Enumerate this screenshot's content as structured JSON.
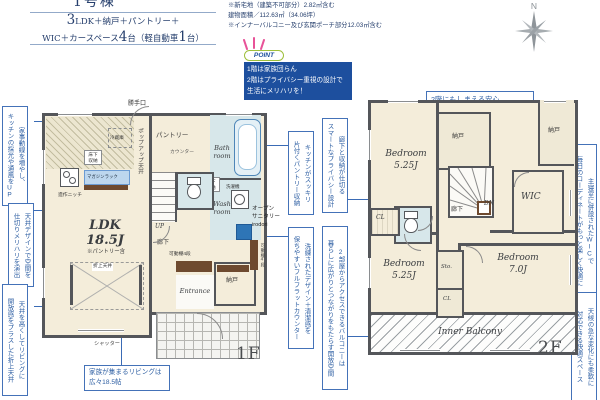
{
  "header": {
    "unit_label": "1号棟",
    "plan_big_1": "3",
    "plan_rest_1": "LDK＋納戸＋パントリー＋",
    "plan_pre_2": "WIC＋カースペース",
    "plan_big_2": "4",
    "plan_mid_2": "台（軽自動車",
    "plan_big_3": "1",
    "plan_post_2": "台）",
    "note_1": "※新宅地（建築不可部分）2.82㎡含む",
    "note_2": "建物面積／112.63㎡（34.06坪）",
    "note_3": "※インナーバルコニー及び玄関ポーチ部分12.03㎡含む",
    "compass_n": "N"
  },
  "point": {
    "badge": "POINT",
    "body": "1階は家族団らん\n2階はプライバシー重視の設計で\n生活にメリハリを！"
  },
  "callouts": {
    "left_kitchen": "家事動線を増やし、\nキッチンの採光や通風をUP",
    "left_ceiling": "天井デザインで空間を\n仕切りメリハリを演出",
    "left_living": "天井を高くしてリビングに\n開放感をプラスした折上天井",
    "mid_pantry": "キッチンがスッキリ\n片付くパントリー収納",
    "mid_privacy": "廊下と収納が仕切る\nスマートなプライバシー設計",
    "mid_counter": "洗練されたデザイン＋清潔感を\n保ちやすいフルフラットカウンター",
    "mid_balcony": "2部屋からアクセスできるバルコニーは\n暮らしに広がりとつながりをもたらす開放空間",
    "right_storage": "2階にもしまえる安心\n片付けが続く住まい",
    "right_wic": "主寝室に併設されたWICで\n毎日のコーディネートがもっと楽しく快適に",
    "right_balcony": "天候の急な変化にも柔軟に\n対応できる快適スペース",
    "living_size": "家族が集まるリビングは\n広々18.5帖"
  },
  "floor1": {
    "label": "1F",
    "katteguchi": "勝手口",
    "reizouko": "冷蔵庫",
    "yukashita_kitchen": "床下\n収納",
    "popup_ceiling": "ポップアップ天井",
    "magazine_rack": "マガジンラック",
    "zousaku_niche": "造作ニッチ",
    "pantry": "パントリー",
    "counter": "カウンター",
    "bath": "Bath\nroom",
    "yukashita_wash": "床下\n収納",
    "wash": "Wash\nroom",
    "sentakuki": "洗濯機",
    "open_sanitary": "オープン\nサニタリー\nirodori",
    "up": "UP",
    "rouka": "廊下",
    "kadoudana_h": "可動棚4段",
    "kadoudana_v": "可動棚4段",
    "nando": "納戸",
    "entrance": "Entrance",
    "ldk": "LDK\n18.5J",
    "ldk_note": "※パントリー含",
    "oriage_tenjou": "折上天井",
    "shutter": "シャッター"
  },
  "floor2": {
    "label": "2F",
    "bedroom_nw": "Bedroom\n5.25J",
    "nando_mid": "納戸",
    "nando_ne": "納戸",
    "dn": "DN",
    "rouka": "廊下",
    "wic": "WIC",
    "cl_w": "CL",
    "bedroom_sw": "Bedroom\n5.25J",
    "sto": "Sto.",
    "cl_mid": "CL",
    "bedroom_se": "Bedroom\n7.0J",
    "balcony": "Inner Balcony"
  }
}
